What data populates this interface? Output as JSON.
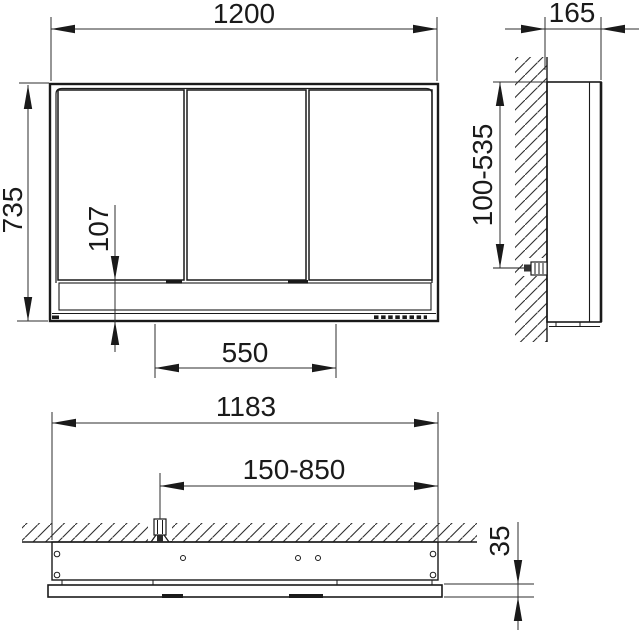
{
  "dims": {
    "front_width": "1200",
    "front_height": "735",
    "front_bottom_panel": "107",
    "front_center_span": "550",
    "side_depth": "165",
    "side_connection_range": "100-535",
    "plan_body_width": "1183",
    "plan_connection_range": "150-850",
    "plan_panel_thickness": "35"
  },
  "colors": {
    "line": "#1a1a1a",
    "dim_line": "#2e2e2e",
    "background": "#ffffff"
  }
}
